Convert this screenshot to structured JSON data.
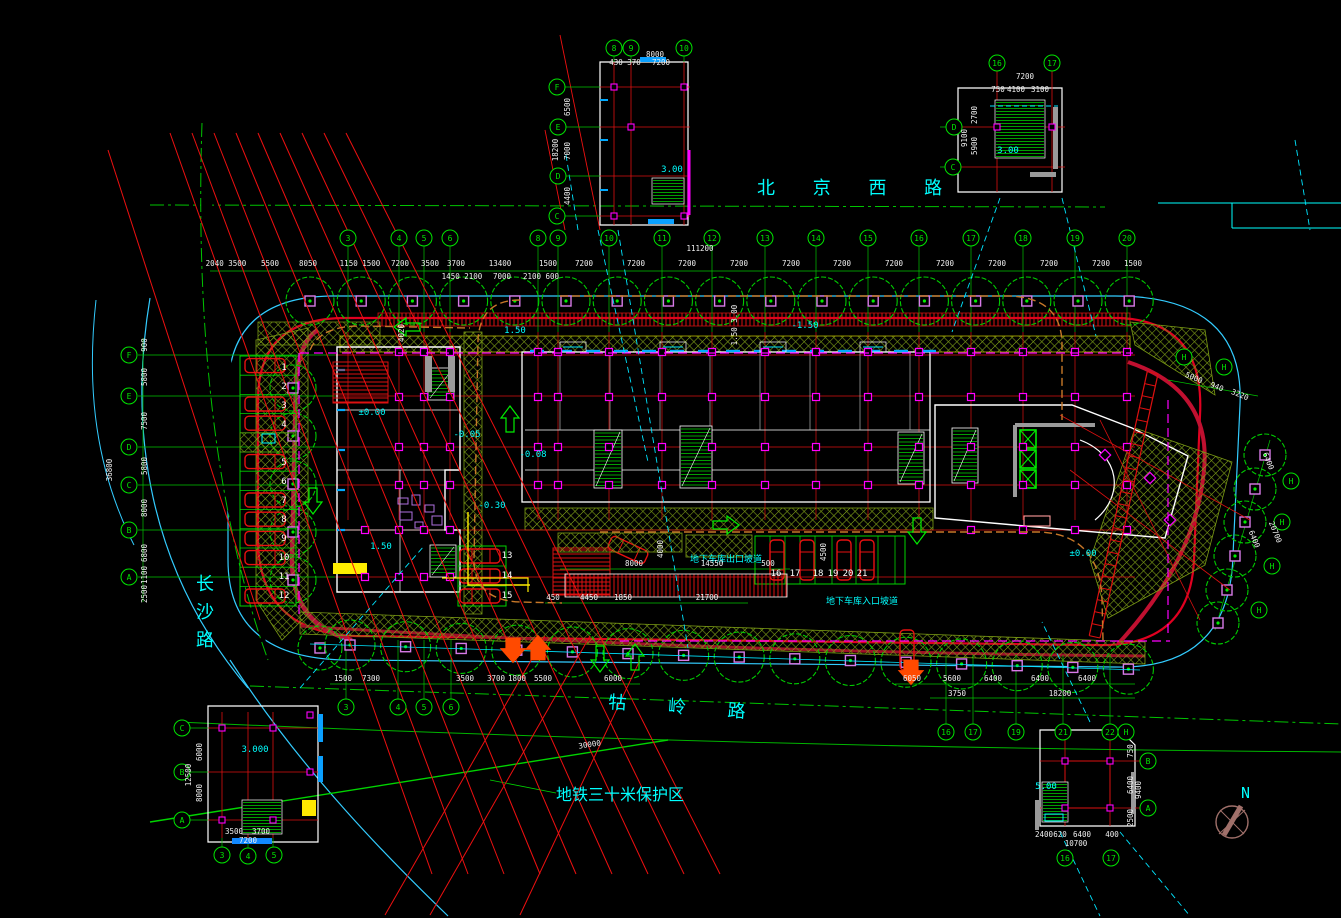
{
  "colors": {
    "background": "#000000",
    "grid_green": "#00d400",
    "red": "#ee1010",
    "bright_red": "#ff2020",
    "crimson": "#b5123a",
    "cyan": "#00ffff",
    "light_blue": "#33ccff",
    "blue": "#1e90ff",
    "magenta": "#ff00ff",
    "violet": "#d87ae8",
    "yellow": "#ffee00",
    "orange": "#ff5500",
    "orange_dash": "#c87828",
    "hatch_green": "#93b81e",
    "dim_white": "#f0f0f0",
    "maroon": "#a0706a",
    "grey": "#9a9a9a"
  },
  "roads": {
    "north": "北 京 西 路",
    "west": "长沙路",
    "south": "牯 岭 路"
  },
  "labels": {
    "subway_zone": "地铁三十米保护区",
    "subway_dim": "30000",
    "exit_ramp": "地下车库出口坡道",
    "entry_ramp": "地下车库入口坡道",
    "north_mark": "N"
  },
  "grid_bubbles": [
    {
      "l": "3",
      "x": 348,
      "y": 238
    },
    {
      "l": "4",
      "x": 399,
      "y": 238
    },
    {
      "l": "5",
      "x": 424,
      "y": 238
    },
    {
      "l": "6",
      "x": 450,
      "y": 238
    },
    {
      "l": "8",
      "x": 538,
      "y": 238
    },
    {
      "l": "9",
      "x": 558,
      "y": 238
    },
    {
      "l": "10",
      "x": 609,
      "y": 238
    },
    {
      "l": "11",
      "x": 662,
      "y": 238
    },
    {
      "l": "12",
      "x": 712,
      "y": 238
    },
    {
      "l": "13",
      "x": 765,
      "y": 238
    },
    {
      "l": "14",
      "x": 816,
      "y": 238
    },
    {
      "l": "15",
      "x": 868,
      "y": 238
    },
    {
      "l": "16",
      "x": 919,
      "y": 238
    },
    {
      "l": "17",
      "x": 971,
      "y": 238
    },
    {
      "l": "18",
      "x": 1023,
      "y": 238
    },
    {
      "l": "19",
      "x": 1075,
      "y": 238
    },
    {
      "l": "20",
      "x": 1127,
      "y": 238
    },
    {
      "l": "F",
      "x": 129,
      "y": 355
    },
    {
      "l": "E",
      "x": 129,
      "y": 396
    },
    {
      "l": "D",
      "x": 129,
      "y": 447
    },
    {
      "l": "C",
      "x": 129,
      "y": 485
    },
    {
      "l": "B",
      "x": 129,
      "y": 530
    },
    {
      "l": "A",
      "x": 129,
      "y": 577
    },
    {
      "l": "3",
      "x": 346,
      "y": 707
    },
    {
      "l": "4",
      "x": 398,
      "y": 707
    },
    {
      "l": "5",
      "x": 424,
      "y": 707
    },
    {
      "l": "6",
      "x": 451,
      "y": 707
    },
    {
      "l": "16",
      "x": 946,
      "y": 732
    },
    {
      "l": "17",
      "x": 973,
      "y": 732
    },
    {
      "l": "19",
      "x": 1016,
      "y": 732
    },
    {
      "l": "21",
      "x": 1063,
      "y": 732
    },
    {
      "l": "22",
      "x": 1110,
      "y": 732
    },
    {
      "l": "H",
      "x": 1126,
      "y": 732
    },
    {
      "l": "H",
      "x": 1184,
      "y": 357
    },
    {
      "l": "H",
      "x": 1224,
      "y": 367
    },
    {
      "l": "H",
      "x": 1291,
      "y": 481
    },
    {
      "l": "H",
      "x": 1282,
      "y": 522
    },
    {
      "l": "H",
      "x": 1272,
      "y": 566
    },
    {
      "l": "H",
      "x": 1259,
      "y": 610
    },
    {
      "l": "8",
      "x": 614,
      "y": 48
    },
    {
      "l": "9",
      "x": 631,
      "y": 48
    },
    {
      "l": "10",
      "x": 684,
      "y": 48
    },
    {
      "l": "F",
      "x": 557,
      "y": 87
    },
    {
      "l": "E",
      "x": 558,
      "y": 127
    },
    {
      "l": "D",
      "x": 558,
      "y": 176
    },
    {
      "l": "C",
      "x": 557,
      "y": 216
    },
    {
      "l": "16",
      "x": 997,
      "y": 63
    },
    {
      "l": "17",
      "x": 1052,
      "y": 63
    },
    {
      "l": "D",
      "x": 954,
      "y": 127
    },
    {
      "l": "C",
      "x": 953,
      "y": 167
    },
    {
      "l": "C",
      "x": 182,
      "y": 728
    },
    {
      "l": "B",
      "x": 182,
      "y": 772
    },
    {
      "l": "A",
      "x": 182,
      "y": 820
    },
    {
      "l": "3",
      "x": 222,
      "y": 855
    },
    {
      "l": "4",
      "x": 248,
      "y": 856
    },
    {
      "l": "5",
      "x": 274,
      "y": 855
    },
    {
      "l": "B",
      "x": 1148,
      "y": 761
    },
    {
      "l": "A",
      "x": 1148,
      "y": 808
    },
    {
      "l": "16",
      "x": 1065,
      "y": 858
    },
    {
      "l": "17",
      "x": 1111,
      "y": 858
    }
  ],
  "dims": [
    {
      "t": "111200",
      "x": 700,
      "y": 251
    },
    {
      "t": "2040 3500",
      "x": 226,
      "y": 266
    },
    {
      "t": "5500",
      "x": 270,
      "y": 266
    },
    {
      "t": "8050",
      "x": 308,
      "y": 266
    },
    {
      "t": "1150 1500",
      "x": 360,
      "y": 266
    },
    {
      "t": "7200",
      "x": 400,
      "y": 266
    },
    {
      "t": "3500",
      "x": 430,
      "y": 266
    },
    {
      "t": "3700",
      "x": 456,
      "y": 266
    },
    {
      "t": "13400",
      "x": 500,
      "y": 266
    },
    {
      "t": "1500",
      "x": 548,
      "y": 266
    },
    {
      "t": "7200",
      "x": 584,
      "y": 266
    },
    {
      "t": "7200",
      "x": 636,
      "y": 266
    },
    {
      "t": "7200",
      "x": 687,
      "y": 266
    },
    {
      "t": "7200",
      "x": 739,
      "y": 266
    },
    {
      "t": "7200",
      "x": 791,
      "y": 266
    },
    {
      "t": "7200",
      "x": 842,
      "y": 266
    },
    {
      "t": "7200",
      "x": 894,
      "y": 266
    },
    {
      "t": "7200",
      "x": 945,
      "y": 266
    },
    {
      "t": "7200",
      "x": 997,
      "y": 266
    },
    {
      "t": "7200",
      "x": 1049,
      "y": 266
    },
    {
      "t": "7200",
      "x": 1101,
      "y": 266
    },
    {
      "t": "1500",
      "x": 1133,
      "y": 266
    },
    {
      "t": "1450 2100",
      "x": 462,
      "y": 279
    },
    {
      "t": "7000",
      "x": 502,
      "y": 279
    },
    {
      "t": "2100 600",
      "x": 541,
      "y": 279
    },
    {
      "t": "900",
      "x": 147,
      "y": 345,
      "r": -90
    },
    {
      "t": "5800",
      "x": 147,
      "y": 377,
      "r": -90
    },
    {
      "t": "7500",
      "x": 147,
      "y": 421,
      "r": -90
    },
    {
      "t": "5800",
      "x": 147,
      "y": 466,
      "r": -90
    },
    {
      "t": "8000",
      "x": 147,
      "y": 508,
      "r": -90
    },
    {
      "t": "6800",
      "x": 147,
      "y": 553,
      "r": -90
    },
    {
      "t": "1100",
      "x": 147,
      "y": 575,
      "r": -90
    },
    {
      "t": "2500",
      "x": 147,
      "y": 594,
      "r": -90
    },
    {
      "t": "36800",
      "x": 112,
      "y": 470,
      "r": -90
    },
    {
      "t": "1500",
      "x": 343,
      "y": 681
    },
    {
      "t": "7300",
      "x": 371,
      "y": 681
    },
    {
      "t": "3500",
      "x": 465,
      "y": 681
    },
    {
      "t": "3700",
      "x": 496,
      "y": 681
    },
    {
      "t": "1800",
      "x": 517,
      "y": 681
    },
    {
      "t": "5500",
      "x": 543,
      "y": 681
    },
    {
      "t": "6000",
      "x": 613,
      "y": 681
    },
    {
      "t": "6050",
      "x": 912,
      "y": 681
    },
    {
      "t": "5600",
      "x": 952,
      "y": 681
    },
    {
      "t": "6400",
      "x": 993,
      "y": 681
    },
    {
      "t": "6400",
      "x": 1040,
      "y": 681
    },
    {
      "t": "6400",
      "x": 1087,
      "y": 681
    },
    {
      "t": "3750",
      "x": 957,
      "y": 696
    },
    {
      "t": "18200",
      "x": 1060,
      "y": 696
    },
    {
      "t": "8000",
      "x": 634,
      "y": 566
    },
    {
      "t": "14550",
      "x": 712,
      "y": 566
    },
    {
      "t": "500",
      "x": 768,
      "y": 566
    },
    {
      "t": "450",
      "x": 553,
      "y": 600
    },
    {
      "t": "4450",
      "x": 589,
      "y": 600
    },
    {
      "t": "1850",
      "x": 623,
      "y": 600
    },
    {
      "t": "21700",
      "x": 707,
      "y": 600
    },
    {
      "t": "4000",
      "x": 663,
      "y": 549,
      "r": -90
    },
    {
      "t": "4500",
      "x": 826,
      "y": 552,
      "r": -90
    },
    {
      "t": "4020",
      "x": 404,
      "y": 333,
      "r": -90
    },
    {
      "t": "1.50 3.00",
      "x": 737,
      "y": 325,
      "r": -90
    },
    {
      "t": "5000",
      "x": 1193,
      "y": 380,
      "r": 22
    },
    {
      "t": "940",
      "x": 1216,
      "y": 389,
      "r": 22
    },
    {
      "t": "3220",
      "x": 1239,
      "y": 397,
      "r": 22
    },
    {
      "t": "6400",
      "x": 1266,
      "y": 462,
      "r": 68
    },
    {
      "t": "6400",
      "x": 1252,
      "y": 540,
      "r": 68
    },
    {
      "t": "20700",
      "x": 1273,
      "y": 533,
      "r": 68
    },
    {
      "t": "30000",
      "x": 590,
      "y": 747,
      "r": -9
    },
    {
      "t": "8000",
      "x": 655,
      "y": 57
    },
    {
      "t": "430 370",
      "x": 625,
      "y": 65
    },
    {
      "t": "7200",
      "x": 661,
      "y": 65
    },
    {
      "t": "6500",
      "x": 570,
      "y": 107,
      "r": -90
    },
    {
      "t": "7000",
      "x": 570,
      "y": 151,
      "r": -90
    },
    {
      "t": "4400",
      "x": 570,
      "y": 196,
      "r": -90
    },
    {
      "t": "18200",
      "x": 558,
      "y": 150,
      "r": -90
    },
    {
      "t": "7200",
      "x": 1025,
      "y": 79
    },
    {
      "t": "750",
      "x": 998,
      "y": 92
    },
    {
      "t": "4100",
      "x": 1016,
      "y": 92
    },
    {
      "t": "3100",
      "x": 1040,
      "y": 92
    },
    {
      "t": "2700",
      "x": 977,
      "y": 115,
      "r": -90
    },
    {
      "t": "5900",
      "x": 977,
      "y": 146,
      "r": -90
    },
    {
      "t": "9100",
      "x": 967,
      "y": 138,
      "r": -90
    },
    {
      "t": "6000",
      "x": 202,
      "y": 752,
      "r": -90
    },
    {
      "t": "8000",
      "x": 202,
      "y": 793,
      "r": -90
    },
    {
      "t": "12500",
      "x": 191,
      "y": 775,
      "r": -90
    },
    {
      "t": "3500",
      "x": 234,
      "y": 834
    },
    {
      "t": "3700",
      "x": 261,
      "y": 834
    },
    {
      "t": "7200",
      "x": 248,
      "y": 843
    },
    {
      "t": "750",
      "x": 1133,
      "y": 751,
      "r": -90
    },
    {
      "t": "6400",
      "x": 1133,
      "y": 785,
      "r": -90
    },
    {
      "t": "2500",
      "x": 1133,
      "y": 818,
      "r": -90
    },
    {
      "t": "9400",
      "x": 1141,
      "y": 790,
      "r": -90
    },
    {
      "t": "2400",
      "x": 1044,
      "y": 837
    },
    {
      "t": "620",
      "x": 1060,
      "y": 837
    },
    {
      "t": "6400",
      "x": 1082,
      "y": 837
    },
    {
      "t": "400",
      "x": 1112,
      "y": 837
    },
    {
      "t": "10700",
      "x": 1076,
      "y": 846
    }
  ],
  "elevations": [
    {
      "t": "1.50",
      "x": 515,
      "y": 333
    },
    {
      "t": "-1.50",
      "x": 805,
      "y": 328
    },
    {
      "t": "±0.00",
      "x": 372,
      "y": 415
    },
    {
      "t": "-0.05",
      "x": 467,
      "y": 437
    },
    {
      "t": "-0.08",
      "x": 533,
      "y": 457
    },
    {
      "t": "-0.30",
      "x": 492,
      "y": 508
    },
    {
      "t": "1.50",
      "x": 381,
      "y": 549
    },
    {
      "t": "±0.00",
      "x": 1083,
      "y": 556
    },
    {
      "t": "3.00",
      "x": 672,
      "y": 172
    },
    {
      "t": "3.00",
      "x": 1008,
      "y": 153
    },
    {
      "t": "3.000",
      "x": 255,
      "y": 752
    },
    {
      "t": "5.00",
      "x": 1046,
      "y": 789
    }
  ],
  "parking_numbers": [
    {
      "t": "1",
      "x": 284,
      "y": 370
    },
    {
      "t": "2",
      "x": 284,
      "y": 389
    },
    {
      "t": "3",
      "x": 284,
      "y": 408
    },
    {
      "t": "4",
      "x": 284,
      "y": 427
    },
    {
      "t": "5",
      "x": 284,
      "y": 465
    },
    {
      "t": "6",
      "x": 284,
      "y": 484
    },
    {
      "t": "7",
      "x": 284,
      "y": 503
    },
    {
      "t": "8",
      "x": 284,
      "y": 522
    },
    {
      "t": "9",
      "x": 284,
      "y": 541
    },
    {
      "t": "10",
      "x": 284,
      "y": 560
    },
    {
      "t": "11",
      "x": 284,
      "y": 579
    },
    {
      "t": "12",
      "x": 284,
      "y": 598
    },
    {
      "t": "13",
      "x": 507,
      "y": 558
    },
    {
      "t": "14",
      "x": 507,
      "y": 578
    },
    {
      "t": "15",
      "x": 507,
      "y": 598
    },
    {
      "t": "16",
      "x": 776,
      "y": 576
    },
    {
      "t": "17",
      "x": 795,
      "y": 576
    },
    {
      "t": "18",
      "x": 818,
      "y": 576
    },
    {
      "t": "19",
      "x": 833,
      "y": 576
    },
    {
      "t": "20",
      "x": 848,
      "y": 576
    },
    {
      "t": "21",
      "x": 862,
      "y": 576
    }
  ]
}
